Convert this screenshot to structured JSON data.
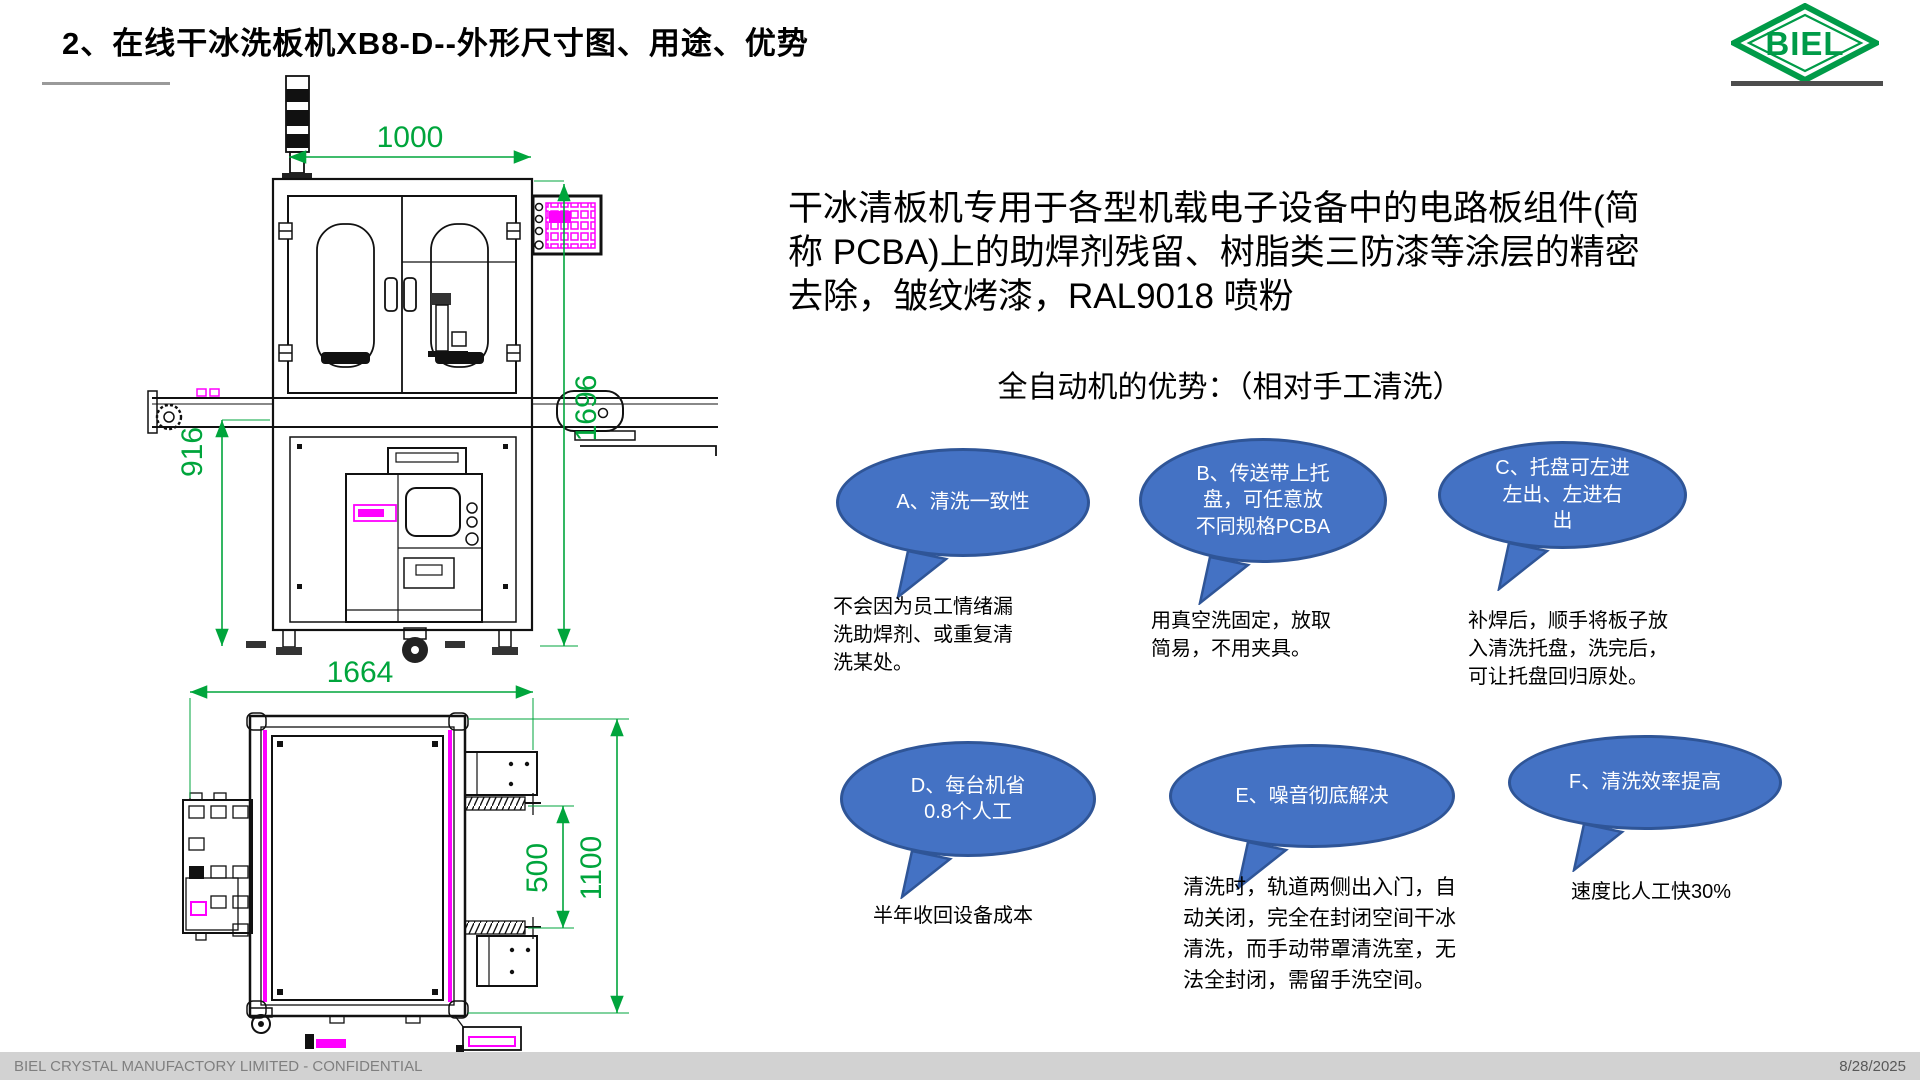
{
  "slide": {
    "title": "2、在线干冰洗板机XB8-D--外形尺寸图、用途、优势",
    "logo_text": "BIEL",
    "footer_left": "BIEL CRYSTAL MANUFACTORY LIMITED - CONFIDENTIAL",
    "footer_right": "8/28/2025"
  },
  "intro": {
    "text": "干冰清板机专用于各型机载电子设备中的电路板组件(简\n称 PCBA)上的助焊剂残留、树脂类三防漆等涂层的精密\n去除，皱纹烤漆，RAL9018 喷粉"
  },
  "advantages": {
    "heading": "全自动机的优势：（相对手工清洗）",
    "items": [
      {
        "id": "A",
        "bubble": "A、清洗一致性",
        "note": "不会因为员工情绪漏\n洗助焊剂、或重复清\n洗某处。"
      },
      {
        "id": "B",
        "bubble": "B、传送带上托\n盘，可任意放\n不同规格PCBA",
        "note": "用真空洗固定，放取\n简易，不用夹具。"
      },
      {
        "id": "C",
        "bubble": "C、托盘可左进\n左出、左进右\n出",
        "note": "补焊后，顺手将板子放\n入清洗托盘，洗完后，\n可让托盘回归原处。"
      },
      {
        "id": "D",
        "bubble": "D、每台机省\n0.8个人工",
        "note": "半年收回设备成本"
      },
      {
        "id": "E",
        "bubble": "E、噪音彻底解决",
        "note": "清洗时，轨道两侧出入门，自\n动关闭，完全在封闭空间干冰\n清洗，而手动带罩清洗室，无\n法全封闭，需留手洗空间。"
      },
      {
        "id": "F",
        "bubble": "F、清洗效率提高",
        "note": "速度比人工快30%"
      }
    ]
  },
  "drawing": {
    "dims": {
      "front_width": "1000",
      "total_height": "1696",
      "conveyor_height": "916",
      "top_width": "1664",
      "rail_span": "500",
      "depth": "1100"
    }
  },
  "colors": {
    "bubble_fill": "#4472c4",
    "bubble_stroke": "#2f5597",
    "dim_green": "#00a53c",
    "magenta": "#ff00ff",
    "logo_green": "#009b48",
    "footer_bg": "#d2d2d2"
  }
}
